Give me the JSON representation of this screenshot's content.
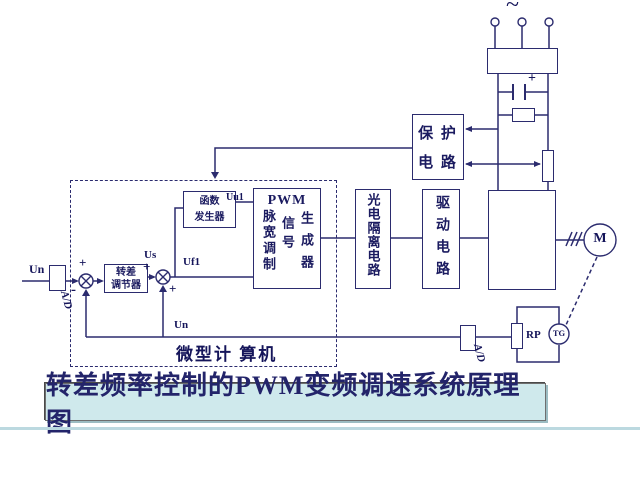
{
  "diagram": {
    "title": "转差频率控制的PWM变频调速系统原理图",
    "ac_symbol": "~",
    "blocks": {
      "protection_line1": "保 护",
      "protection_line2": "电 路",
      "pwm_heading": "PWM",
      "pwm_col1": "脉宽调制",
      "pwm_col2": "信号",
      "pwm_col3": "生成器",
      "opto": "光电隔离电路",
      "drive": "驱动电路",
      "regulator_line1": "转差",
      "regulator_line2": "调节器",
      "function_line1": "函数",
      "function_line2": "发生器",
      "microcomputer": "微型计 算机"
    },
    "signals": {
      "input": "Un",
      "slip": "Us",
      "freq": "Uf1",
      "volt": "Uu1",
      "feedback": "Un",
      "ad_input": "A/D",
      "ad_feedback": "A/D",
      "pot": "RP",
      "tacho": "TG",
      "motor": "M",
      "plus_top": "+",
      "minus": "-",
      "plus_mid": "+",
      "plus_bottom": "+",
      "cap_plus": "+"
    },
    "colors": {
      "line": "#2b2b6e",
      "text": "#1b1b60",
      "title_bg": "#cfe9ec"
    }
  }
}
